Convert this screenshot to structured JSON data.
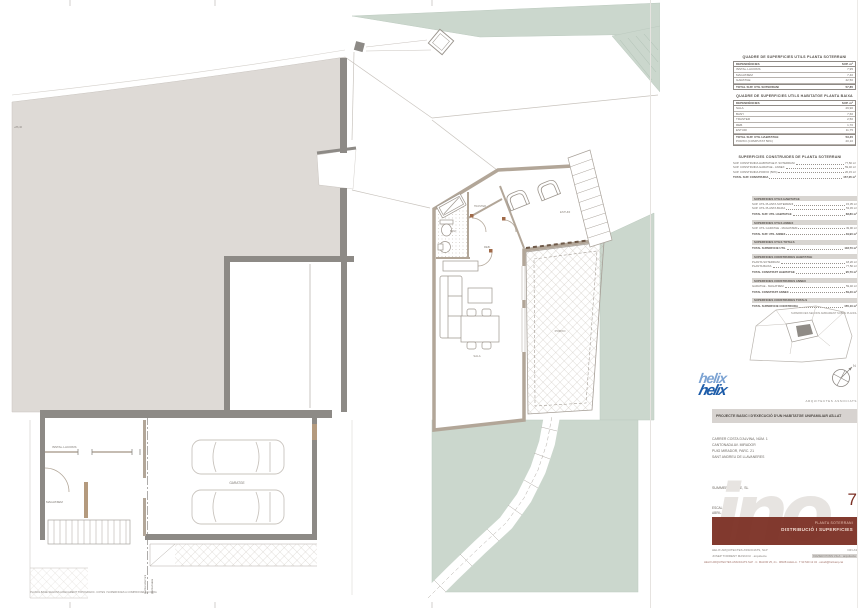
{
  "plan": {
    "labels": {
      "installacions": "INSTAL·LACIONS",
      "magatzem": "MAGATZEM",
      "garatge": "GARATGE",
      "traster": "TRASTER",
      "bany": "BANY",
      "reb": "REB.",
      "sala": "SALA",
      "estudi": "ESTUDI",
      "porxo": "PORXO",
      "level": "+86,40",
      "section_a": "planta soterrani",
      "section_b": "planta baixa",
      "footnote": "PLANOL BASE SEGONS AIXECAMENT TOPOGRAFIC. COTES I SUPERFICIES A COMPROVAR EN OBRA"
    },
    "colors": {
      "green": "#cbd7cd",
      "earth": "#dedad6",
      "wall": "#8d8a86",
      "taupe": "#b2a698"
    }
  },
  "tables": {
    "soterrani": {
      "title": "QUADRE DE SUPERFICIES UTILS PLANTA SOTERRANI",
      "col_label": "DEPENDÈNCIES",
      "col_value": "SUP. m²",
      "rows": [
        {
          "label": "INSTAL·LACIONS",
          "value": "7,95"
        },
        {
          "label": "MAGATZEM",
          "value": "7,40"
        },
        {
          "label": "GARATGE",
          "value": "42,50"
        }
      ],
      "total_label": "TOTAL SUP. UTIL SOTERRANI",
      "total_value": "57,85"
    },
    "habitatge": {
      "title": "QUADRE DE SUPERFICIES UTILS HABITATGE PLANTA BAIXA",
      "col_label": "DEPENDÈNCIES",
      "col_value": "SUP. m²",
      "rows": [
        {
          "label": "SALA",
          "value": "29,90"
        },
        {
          "label": "BANY",
          "value": "7,60"
        },
        {
          "label": "TRASTER",
          "value": "2,50"
        },
        {
          "label": "REB.",
          "value": "1,70"
        },
        {
          "label": "ESTUDI",
          "value": "11,75"
        }
      ],
      "total_label": "TOTAL SUP. UTIL HABITATGE",
      "total_value": "53,45",
      "extra_label": "PORXO (COMPUTAT 50%)",
      "extra_value": "20,10"
    },
    "construides": {
      "title": "SUPERFICIES CONSTRUIDES DE PLANTA SOTERRANI",
      "lines": [
        {
          "label": "SUP. CONSTRUIDA HABITATGE P. SOTERRANI",
          "value": "77,50 m²"
        },
        {
          "label": "SUP. CONSTRUIDA GARATGE - ANNEX",
          "value": "59,40 m²"
        },
        {
          "label": "SUP. CONSTRUIDA PORXO (50%)",
          "value": "20,15 m²"
        }
      ],
      "total_label": "TOTAL SUP. CONSTRUIDA",
      "total_value": "157,05 m²"
    }
  },
  "summary": {
    "blocks": [
      {
        "title": "SUPERFICIES UTILS HABITATGE",
        "lines": [
          {
            "label": "SUP. UTIL PLANTA SOTERRANI",
            "value": "15,35 m²"
          },
          {
            "label": "SUP. UTIL PLANTA BAIXA",
            "value": "53,45 m²"
          },
          {
            "label": "TOTAL SUP. UTIL HABITATGE",
            "value": "68,80 m²"
          }
        ]
      },
      {
        "title": "SUPERFICIES UTILS ANNEX",
        "lines": [
          {
            "label": "SUP. UTIL GARATGE - MAGATZEM",
            "value": "49,90 m²"
          },
          {
            "label": "TOTAL SUP. UTIL ANNEX",
            "value": "49,90 m²"
          }
        ]
      },
      {
        "title": "SUPERFICIES UTILS TOTALS",
        "lines": [
          {
            "label": "TOTAL SUPERFICIE UTIL",
            "value": "118,70 m²"
          }
        ]
      },
      {
        "title": "SUPERFICIES CONSTRUIDES HABITATGE",
        "lines": [
          {
            "label": "PLANTA SOTERRANI",
            "value": "18,20 m²"
          },
          {
            "label": "PLANTA BAIXA",
            "value": "77,50 m²"
          },
          {
            "label": "TOTAL CONSTRUIT HABITATGE",
            "value": "95,70 m²"
          }
        ]
      },
      {
        "title": "SUPERFICIES CONSTRUIDES ANNEX",
        "lines": [
          {
            "label": "GARATGE - MAGATZEM",
            "value": "59,40 m²"
          },
          {
            "label": "TOTAL CONSTRUIT ANNEX",
            "value": "59,40 m²"
          }
        ]
      },
      {
        "title": "SUPERFICIES CONSTRUIDES TOTALS",
        "lines": [
          {
            "label": "TOTAL SUPERFICIE CONSTRUIDA",
            "value": "155,10 m²"
          }
        ]
      }
    ],
    "note": "SUPERFICIES SEGONS AMIDAMENT SOBRE PLANOL"
  },
  "titleblock": {
    "logo_line1": "helix",
    "logo_line2": "helix",
    "firm_tag": "ARQUITECTES ASSOCIATS",
    "project_title": "PROJECTE BASIC I D'EXECUCIÓ D'UN HABITATGE UNIFAMILIAR AÏLLAT",
    "address_lines": [
      "CARRER COSTA D'ALVINA, NÚM. 1",
      "CANTONADA AV. MIRADOR",
      "PUIG MIRADOR, PARC. 21",
      "SANT ANDREU DE LLAVANERES"
    ],
    "client": "SUMMER OFFICE, SL",
    "scale": "ESCALA 1/50",
    "date": "ABRIL 2024",
    "sheet_number": "7",
    "sheet_subtitle1": "PLANTA SOTERRANI",
    "sheet_subtitle2": "DISTRIBUCIÓ I SUPERFICIES",
    "firm_line": "HELIX ARQUITECTES ASSOCIATS, SLP",
    "format_line": "DIN A3",
    "architect_left": "JOSEP TORRENT MASNOU · arquitecte",
    "architect_right": "XAVIER PONS VILA · arquitecte",
    "fine_print": "HELIX ARQUITECTES ASSOCIATS SLP · C. MAJOR 25, 2n · 08328 ALELLA · T 93 540 12 34 · estudi@helixarq.cat",
    "watermark": "ino",
    "north_label": "N"
  }
}
